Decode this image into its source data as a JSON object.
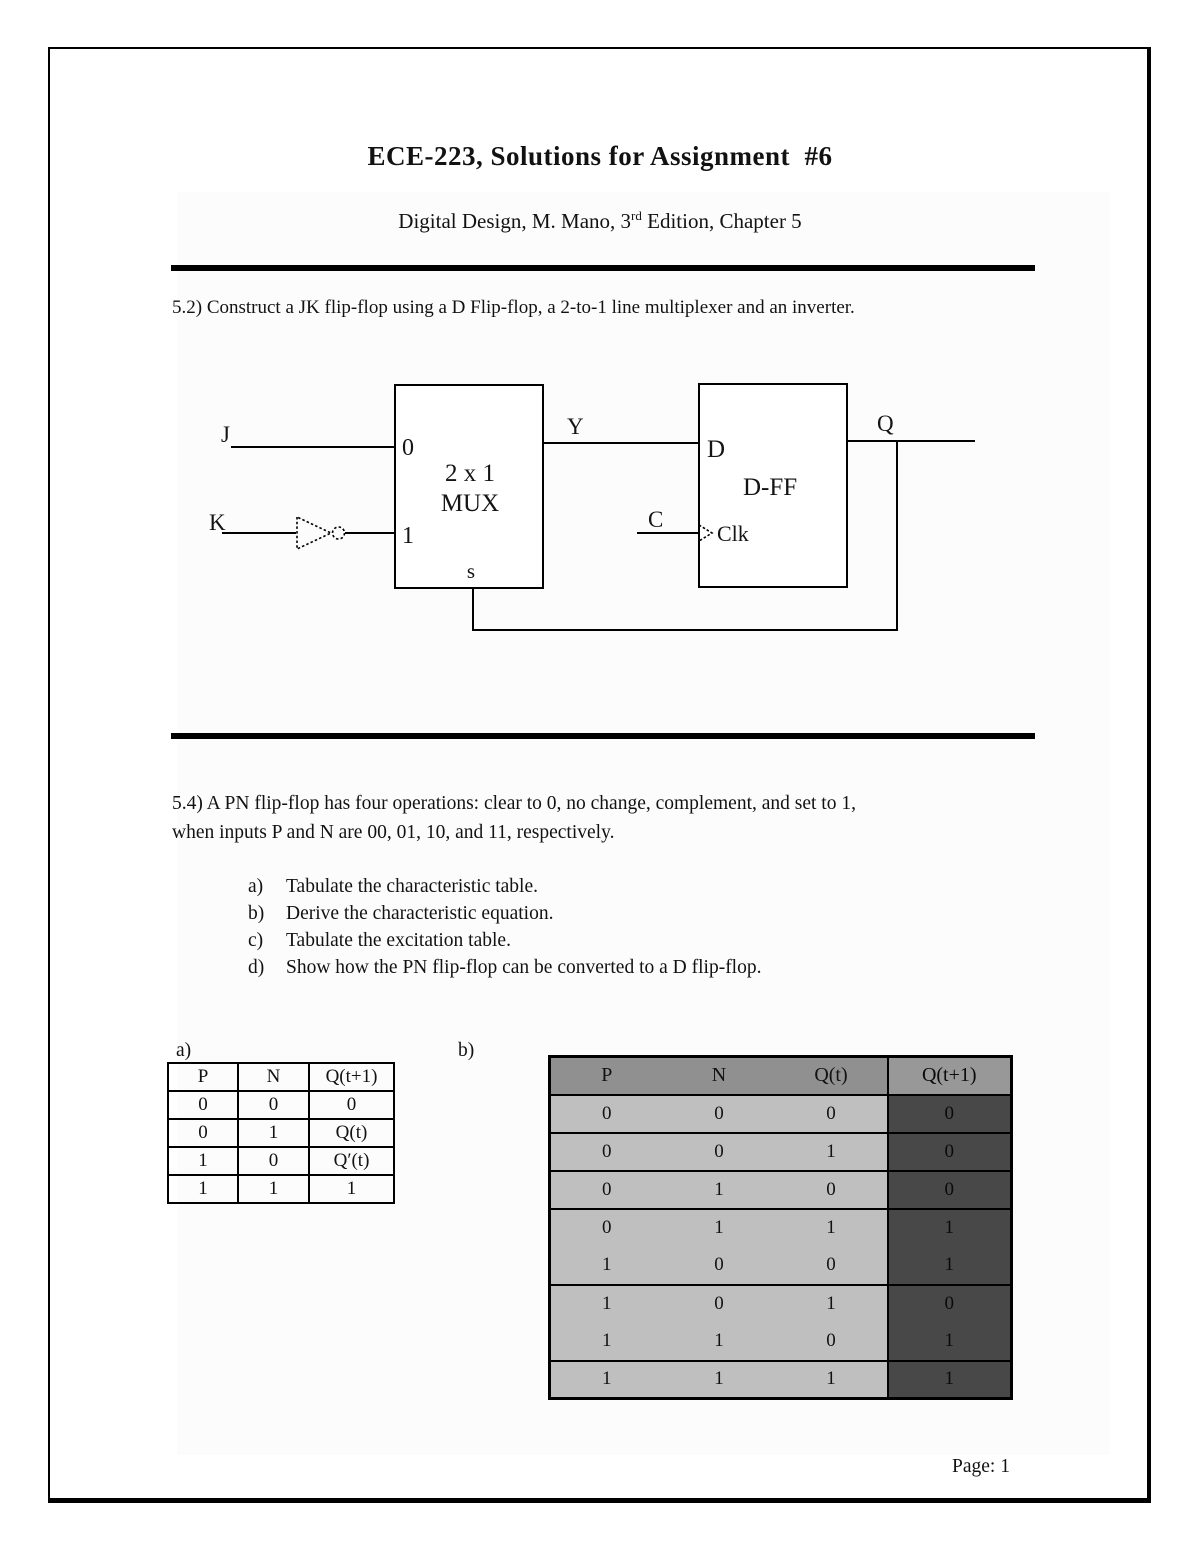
{
  "page": {
    "title": "ECE-223, Solutions for Assignment  #6",
    "subtitle_prefix": "Digital Design, M. Mano, 3",
    "subtitle_sup": "rd",
    "subtitle_suffix": " Edition, Chapter 5",
    "footer": "Page: 1"
  },
  "problem_52": {
    "text": "5.2) Construct a JK flip-flop using a D Flip-flop, a 2-to-1 line multiplexer and an inverter."
  },
  "circuit": {
    "labels": {
      "j": "J",
      "k": "K",
      "mux_in0": "0",
      "mux_in1": "1",
      "mux_name1": "2 x 1",
      "mux_name2": "MUX",
      "mux_select": "s",
      "y": "Y",
      "d": "D",
      "dff": "D-FF",
      "c": "C",
      "clk": "Clk",
      "q": "Q"
    }
  },
  "problem_54": {
    "line1": "5.4) A PN flip-flop has four operations: clear to 0, no change, complement, and set to 1,",
    "line2": "when inputs P and N are 00, 01, 10, and 11, respectively.",
    "items": [
      {
        "marker": "a)",
        "text": "Tabulate the characteristic table."
      },
      {
        "marker": "b)",
        "text": "Derive the characteristic equation."
      },
      {
        "marker": "c)",
        "text": "Tabulate the excitation table."
      },
      {
        "marker": "d)",
        "text": "Show how the PN flip-flop can be converted to a D flip-flop."
      }
    ]
  },
  "table_a": {
    "label": "a)",
    "headers": [
      "P",
      "N",
      "Q(t+1)"
    ],
    "rows": [
      [
        "0",
        "0",
        "0"
      ],
      [
        "0",
        "1",
        "Q(t)"
      ],
      [
        "1",
        "0",
        "Q′(t)"
      ],
      [
        "1",
        "1",
        "1"
      ]
    ]
  },
  "table_b": {
    "label": "b)",
    "headers": [
      "P",
      "N",
      "Q(t)",
      "Q(t+1)"
    ],
    "rows": [
      [
        "0",
        "0",
        "0",
        "0"
      ],
      [
        "0",
        "0",
        "1",
        "0"
      ],
      [
        "0",
        "1",
        "0",
        "0"
      ],
      [
        "0",
        "1",
        "1",
        "1"
      ],
      [
        "1",
        "0",
        "0",
        "1"
      ],
      [
        "1",
        "0",
        "1",
        "0"
      ],
      [
        "1",
        "1",
        "0",
        "1"
      ],
      [
        "1",
        "1",
        "1",
        "1"
      ]
    ],
    "colors": {
      "header_bg": "#909090",
      "body_bg": "#bfbfbf",
      "result_bg": "#484848",
      "border": "#000000"
    }
  }
}
